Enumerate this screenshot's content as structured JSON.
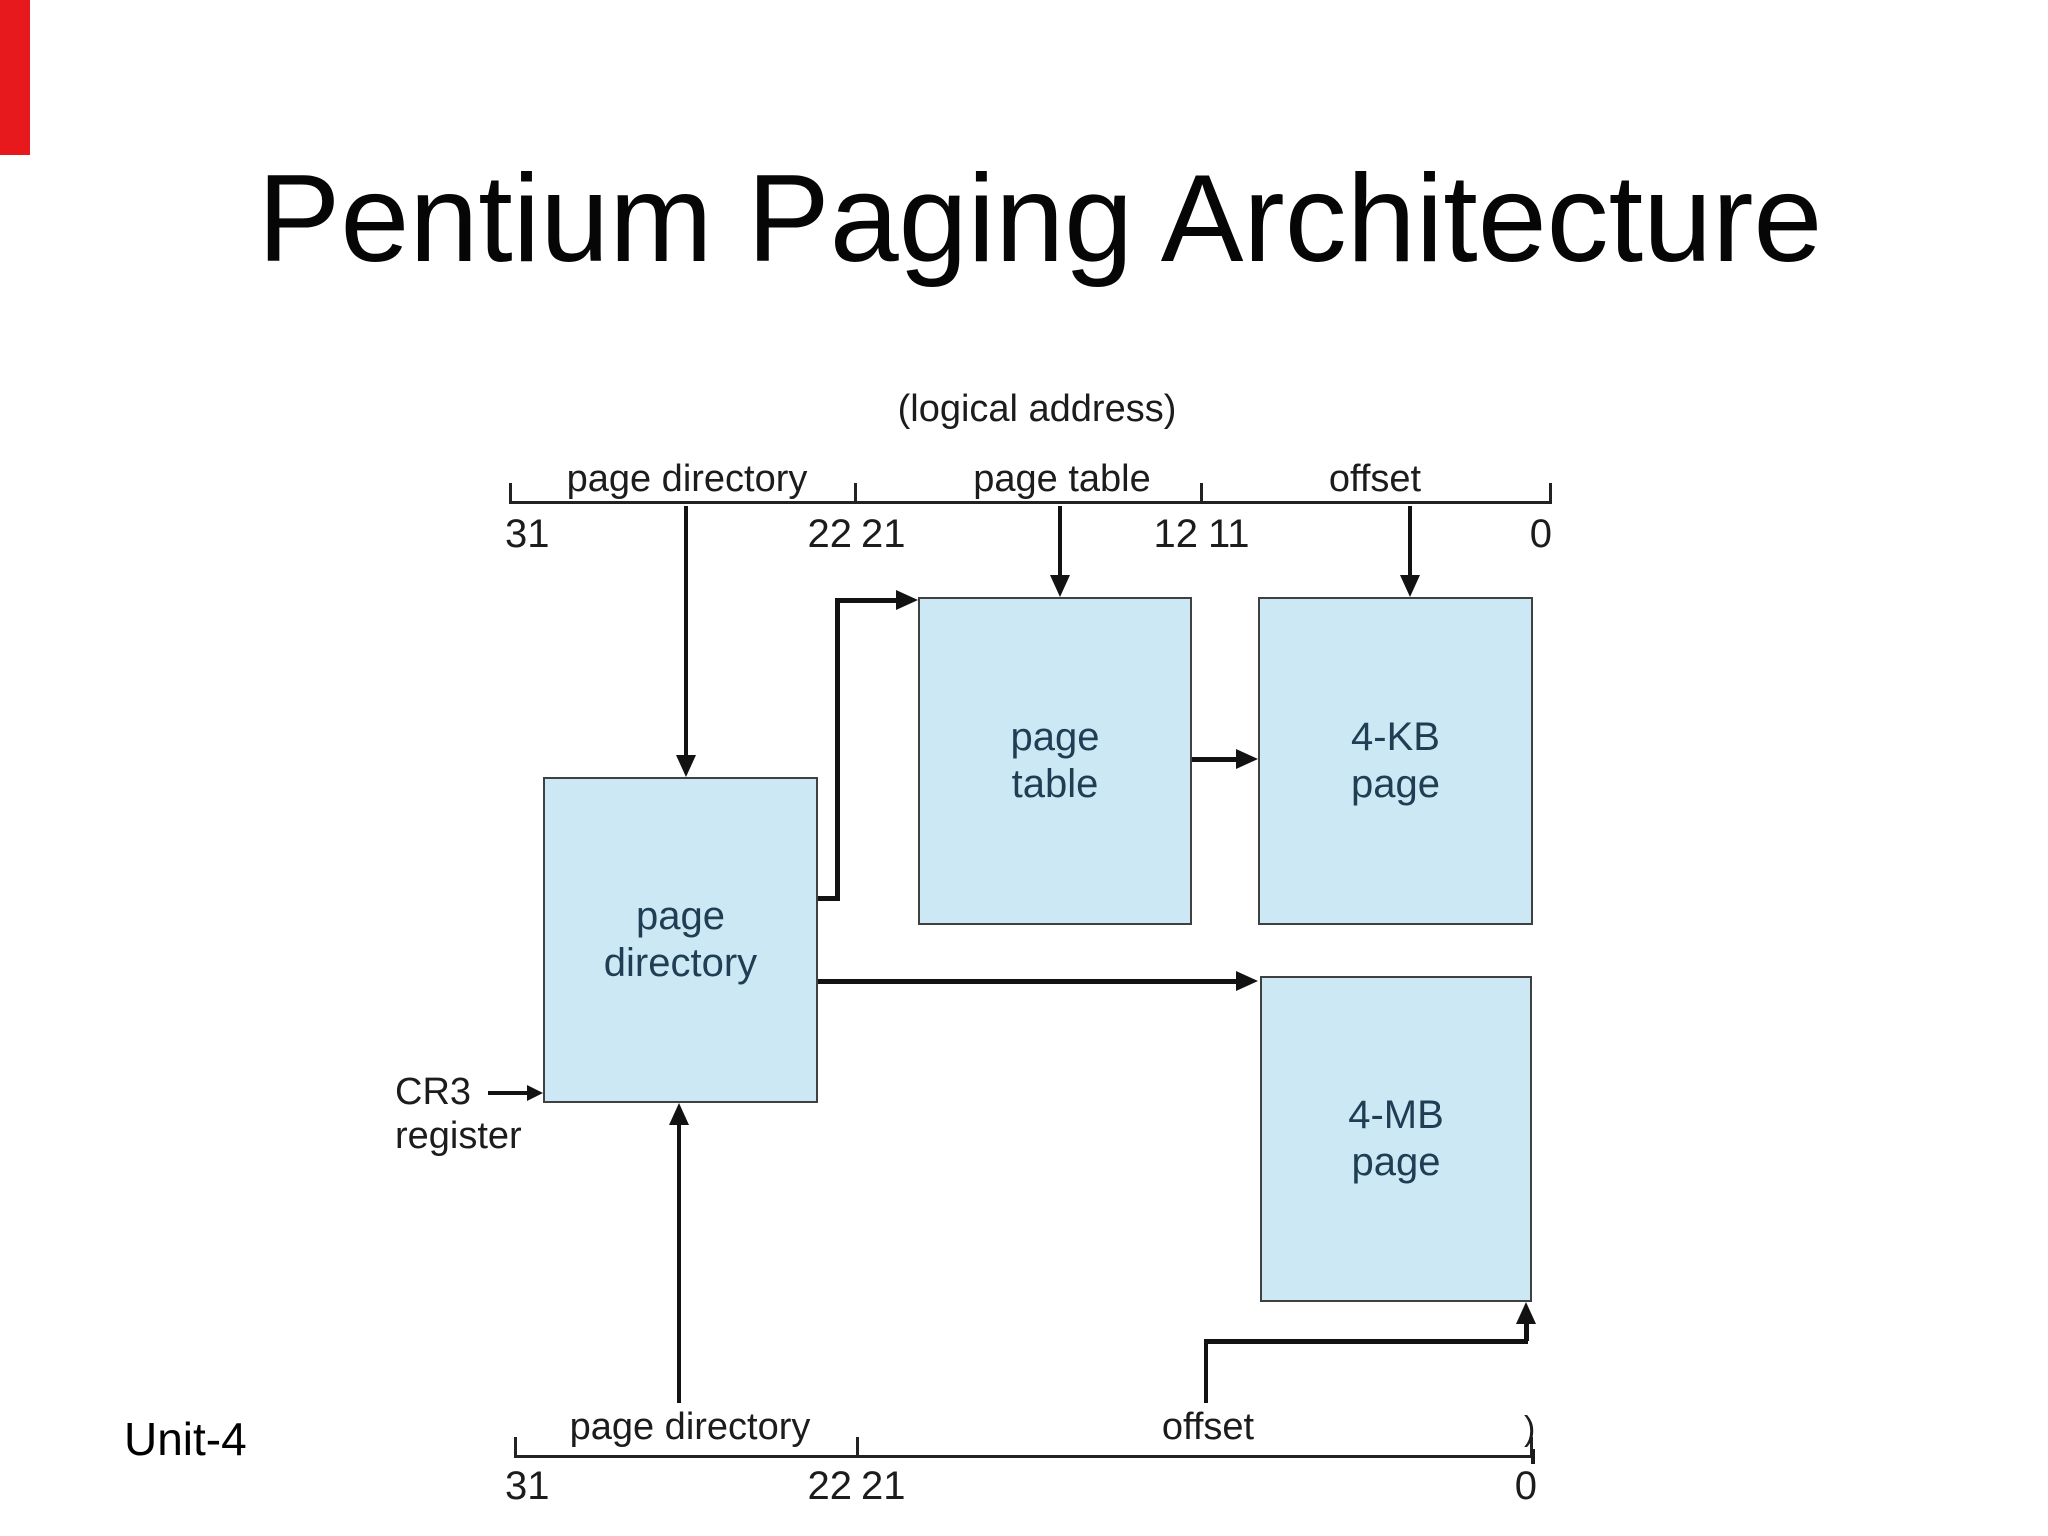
{
  "slide": {
    "title": "Pentium Paging Architecture",
    "footer": "Unit-4"
  },
  "colors": {
    "accent_strip": "#e8191c",
    "box_fill": "#cce8f5",
    "box_border": "#404040",
    "box_text": "#1f3e54",
    "line": "#121212",
    "label_text": "#1c1c1c"
  },
  "diagram": {
    "logical_address_label": "(logical address)",
    "top_bracket": {
      "fields": {
        "page_directory": "page directory",
        "page_table": "page table",
        "offset": "offset"
      },
      "bits": {
        "b31": "31",
        "b22": "22",
        "b21": "21",
        "b12": "12",
        "b11": "11",
        "b0": "0"
      }
    },
    "boxes": {
      "page_directory": "page\ndirectory",
      "page_table": "page\ntable",
      "kb_page": "4-KB\npage",
      "mb_page": "4-MB\npage"
    },
    "cr3_label": "CR3\nregister",
    "bottom_bracket": {
      "fields": {
        "page_directory": "page directory",
        "offset": "offset"
      },
      "bits": {
        "b31": "31",
        "b22": "22",
        "b21": "21",
        "b0": "0"
      },
      "edge_artifact": ")"
    }
  }
}
